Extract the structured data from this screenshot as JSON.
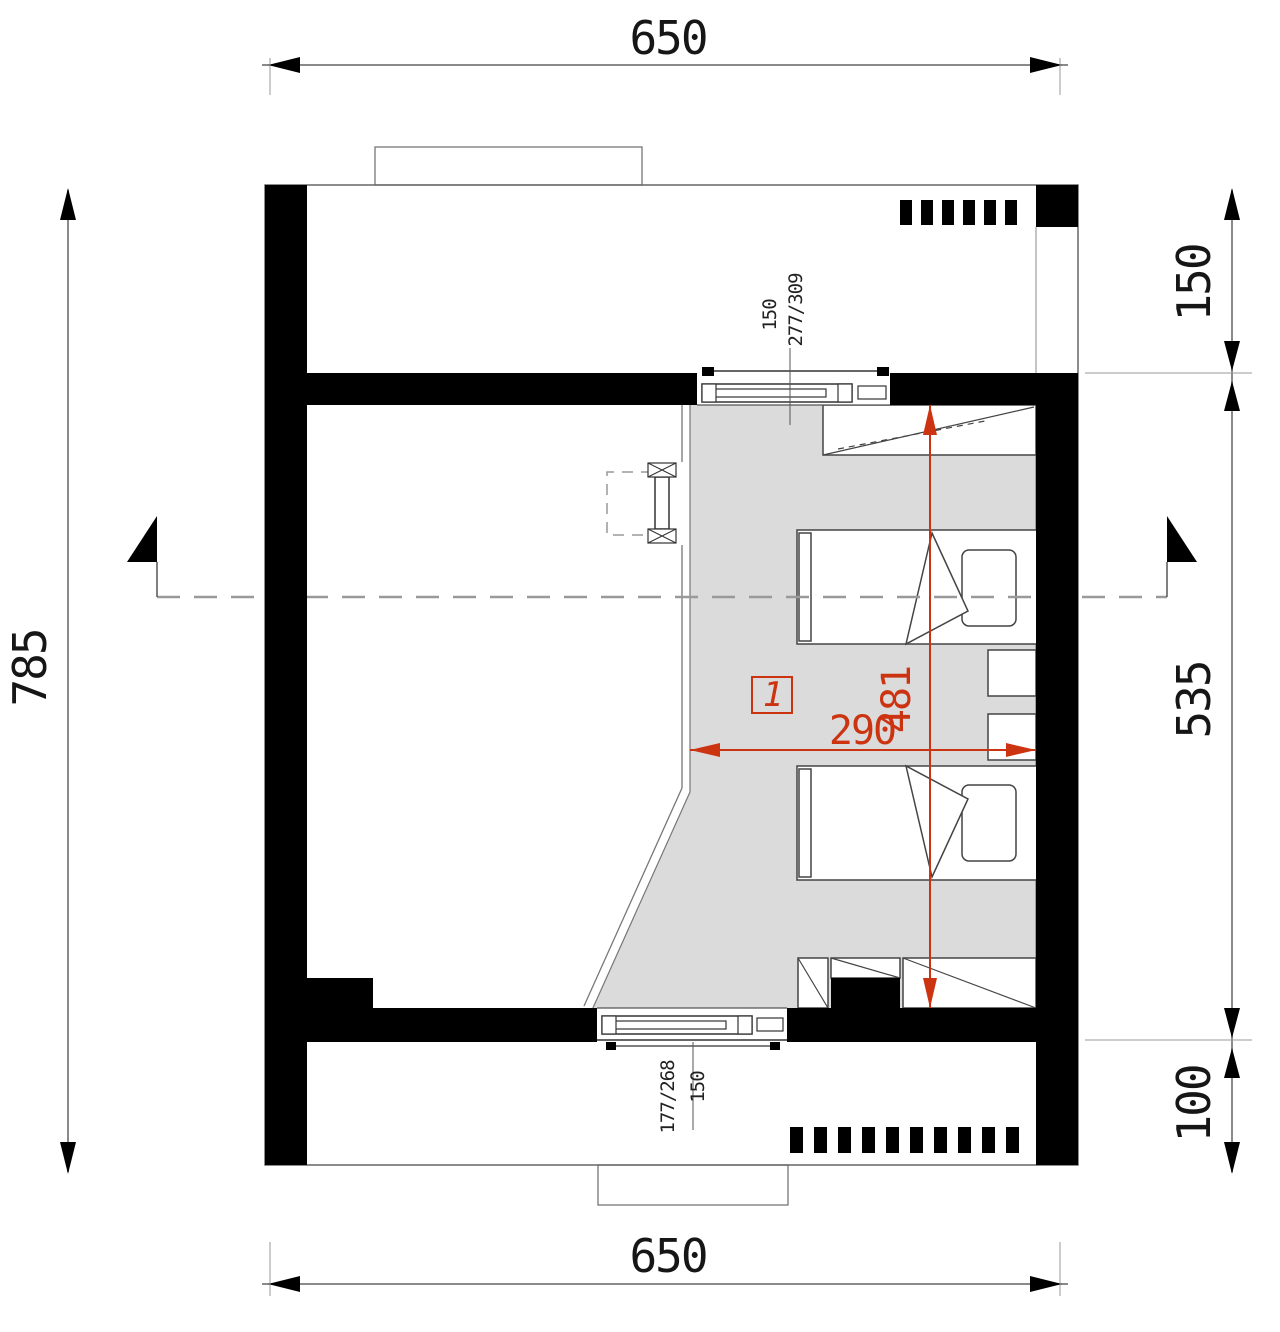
{
  "plan": {
    "title": "attic-floor-plan",
    "room": {
      "number": "1"
    },
    "dimensions": {
      "top_total": "650",
      "bottom_total": "650",
      "left_total": "785",
      "right_segments": [
        "150",
        "535",
        "100"
      ],
      "room_width": "290",
      "room_depth": "481"
    },
    "windows": {
      "top": {
        "sill_height": "150",
        "size": "277/309"
      },
      "bottom": {
        "size": "177/268",
        "sill_height": "150"
      }
    },
    "colors": {
      "accent_red": "#cc3311",
      "room_fill": "#dbdbdb",
      "wall_black": "#000000"
    }
  }
}
